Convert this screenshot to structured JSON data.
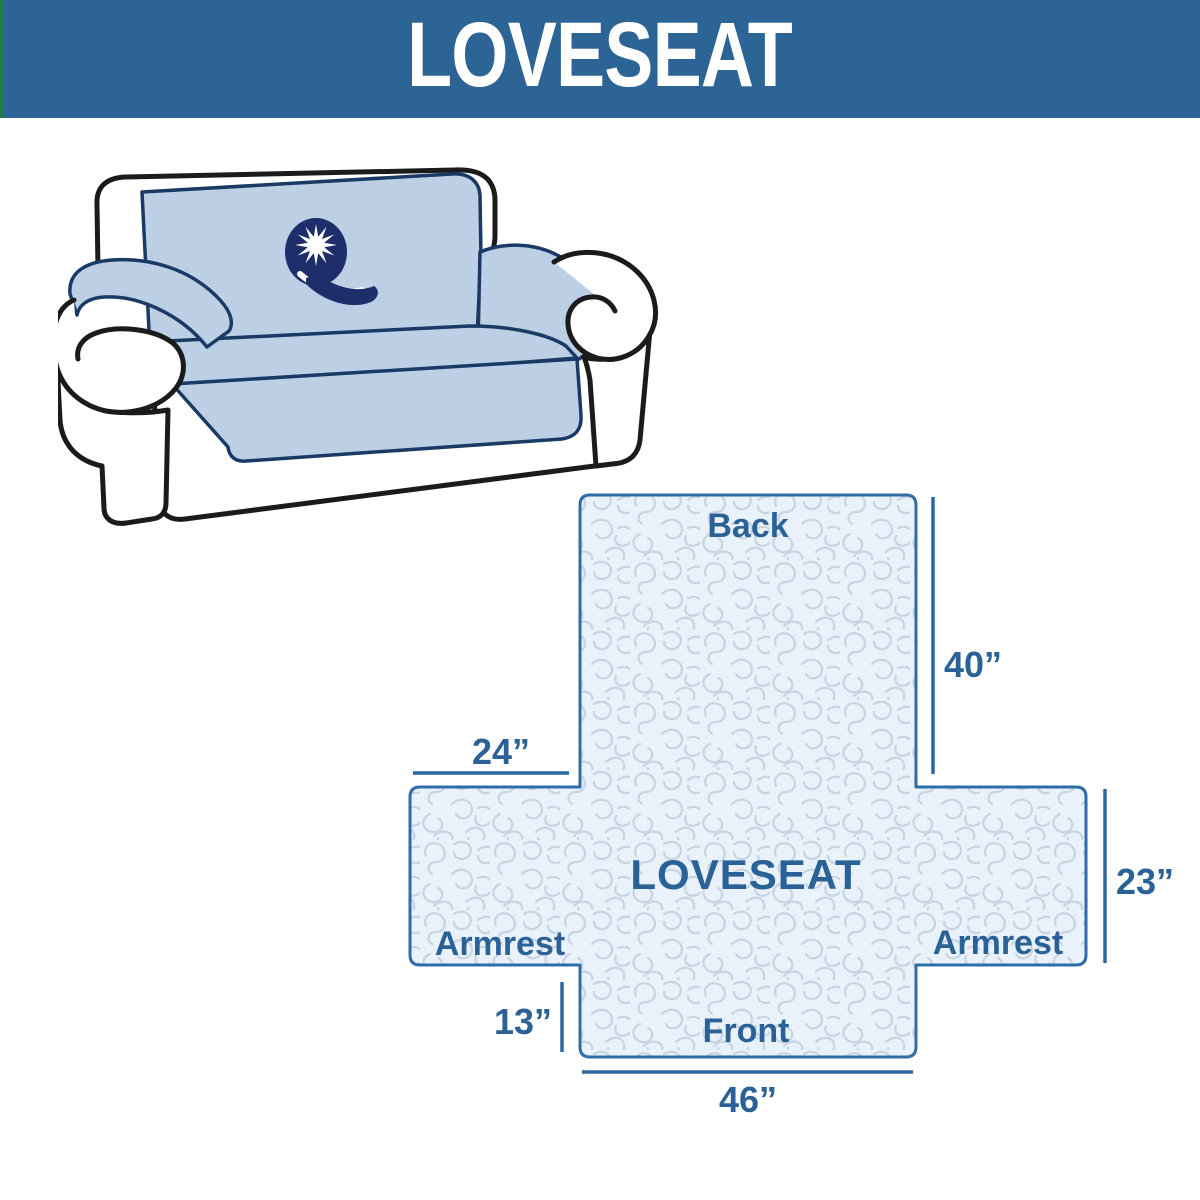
{
  "header": {
    "title": "LOVESEAT"
  },
  "illustration": {
    "logo_icon": "starburst-q-logo"
  },
  "diagram": {
    "center_label": "LOVESEAT",
    "back_label": "Back",
    "front_label": "Front",
    "armrest_left_label": "Armrest",
    "armrest_right_label": "Armrest",
    "dim_back_height": "40”",
    "dim_armrest_width": "24”",
    "dim_armrest_height": "23”",
    "dim_front_height": "13”",
    "dim_front_width": "46”"
  },
  "colors": {
    "header_bg": "#2D6496",
    "header_accent_strip": "#1F7D48",
    "header_text": "#FFFFFF",
    "diagram_fill": "#E9F1FA",
    "diagram_pattern": "#C8D4E2",
    "diagram_border": "#2F6CA8",
    "diagram_text": "#2A6297",
    "slipcover_blue": "#BCCFE5",
    "sofa_outline": "#1B1B1B",
    "logo_navy": "#1D2E6B"
  }
}
